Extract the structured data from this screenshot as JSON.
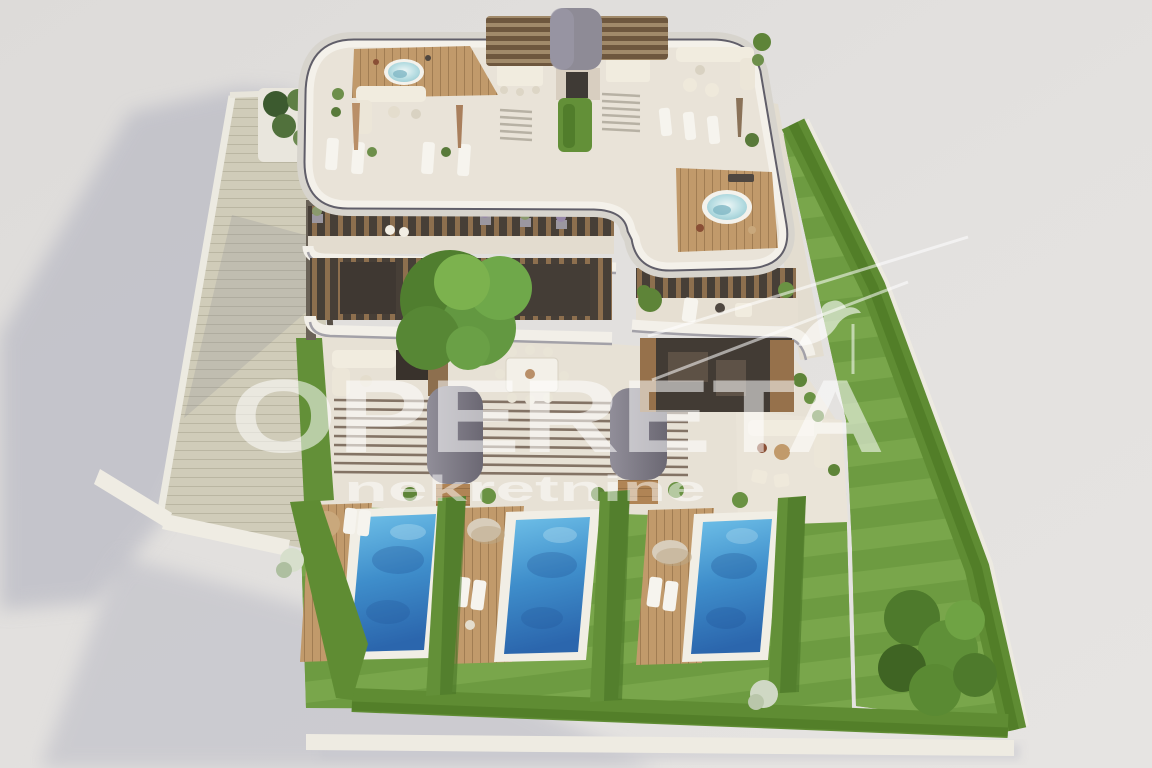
{
  "watermark": {
    "brand": "OPERETA",
    "subtitle": "nekretnine",
    "logo_icon": "house-swallow-logo",
    "text_color": "rgba(255,255,255,0.55)",
    "subtitle_color": "rgba(255,255,255,0.50)"
  },
  "palette": {
    "background": "#e2e0de",
    "cast_shadow": "#b9bac4",
    "lawn_light": "#7aa74c",
    "lawn_dark": "#6c9a40",
    "hedge_green": "#5f8c33",
    "pool_water_light": "#6fc0e8",
    "pool_water_dark": "#2b66ad",
    "wood_deck": "#c19a6b",
    "roof_floor": "#e9e3d8",
    "facade_wood": "#8d6f4e",
    "glass_dark": "#46403b",
    "awning_gray": "#7d7a83",
    "paving": "#e7e1d5",
    "band_white": "#f2efe8",
    "band_dark": "#605e69"
  },
  "scene": {
    "pool_count": 3,
    "pergola_count": 2,
    "rooftop_jacuzzi_count": 2
  }
}
